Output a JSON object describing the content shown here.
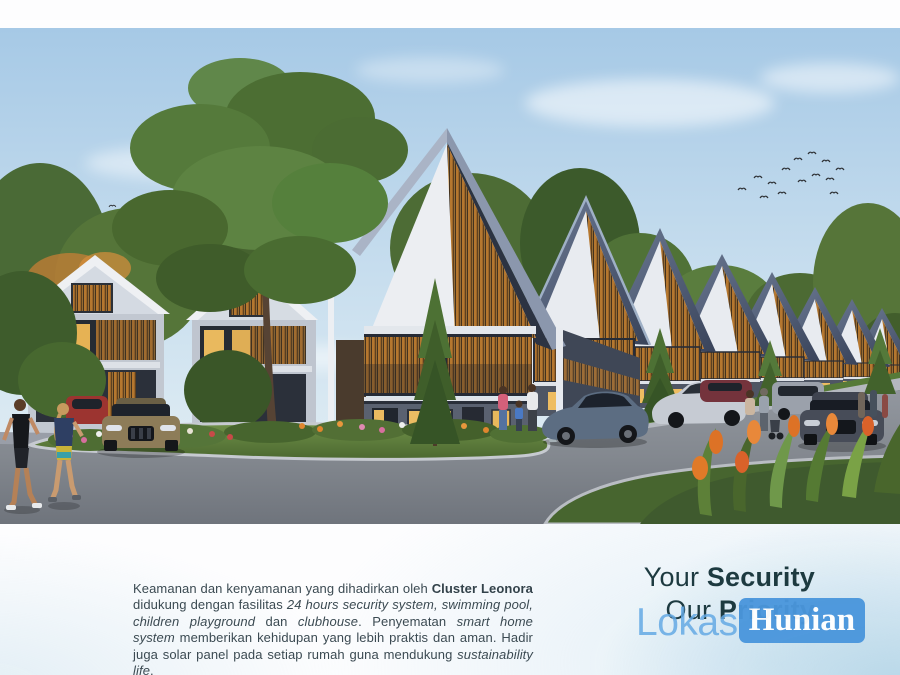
{
  "page": {
    "background": "#fdfdfe"
  },
  "photo": {
    "description": "Architectural rendering of Cluster Leonora: a row of modern two-story townhouses with steep dark gabled roofs and warm wooden louver facades, receding to the right along a curved asphalt road with a landscaped grass island, flower beds, parked cars, a jogging couple and residents walking, trees and flocks of birds in a light blue sky",
    "palette": {
      "sky": "#aecde8",
      "cloud": "#f4f9fc",
      "roof": "#3c485f",
      "roof_light": "#8b97ad",
      "gable_white": "#eceef2",
      "wood_louver": "#b5772f",
      "wall_gray": "#5a6170",
      "grass": "#5d7d3e",
      "road": "#82878f",
      "lit_window": "#ecbd63",
      "bird": "#2f3236"
    }
  },
  "caption": {
    "segments": [
      {
        "style": "regular",
        "text": "Keamanan dan kenyamanan yang dihadirkan oleh "
      },
      {
        "style": "bold",
        "text": "Cluster Leonora"
      },
      {
        "style": "regular",
        "text": " didukung dengan fasilitas "
      },
      {
        "style": "italic",
        "text": "24 hours security system, swimming pool, children playground"
      },
      {
        "style": "regular",
        "text": " dan "
      },
      {
        "style": "italic",
        "text": "clubhouse"
      },
      {
        "style": "regular",
        "text": ". Penyematan "
      },
      {
        "style": "italic",
        "text": "smart home system"
      },
      {
        "style": "regular",
        "text": " memberikan kehidupan yang lebih praktis dan aman. Hadir juga solar panel pada setiap rumah guna mendukung "
      },
      {
        "style": "italic",
        "text": "sustainability life"
      },
      {
        "style": "regular",
        "text": "."
      }
    ]
  },
  "headline": {
    "line1_regular": "Your ",
    "line1_bold": "Security",
    "line2_regular": "Our ",
    "line2_bold": "Priority",
    "color": "#1d3a40"
  },
  "watermark": {
    "part1": "Lokasi",
    "part2": "Hunian",
    "text_color": "#63a9e4",
    "badge_color": "#4a96dc",
    "badge_text_color": "#ffffff"
  }
}
